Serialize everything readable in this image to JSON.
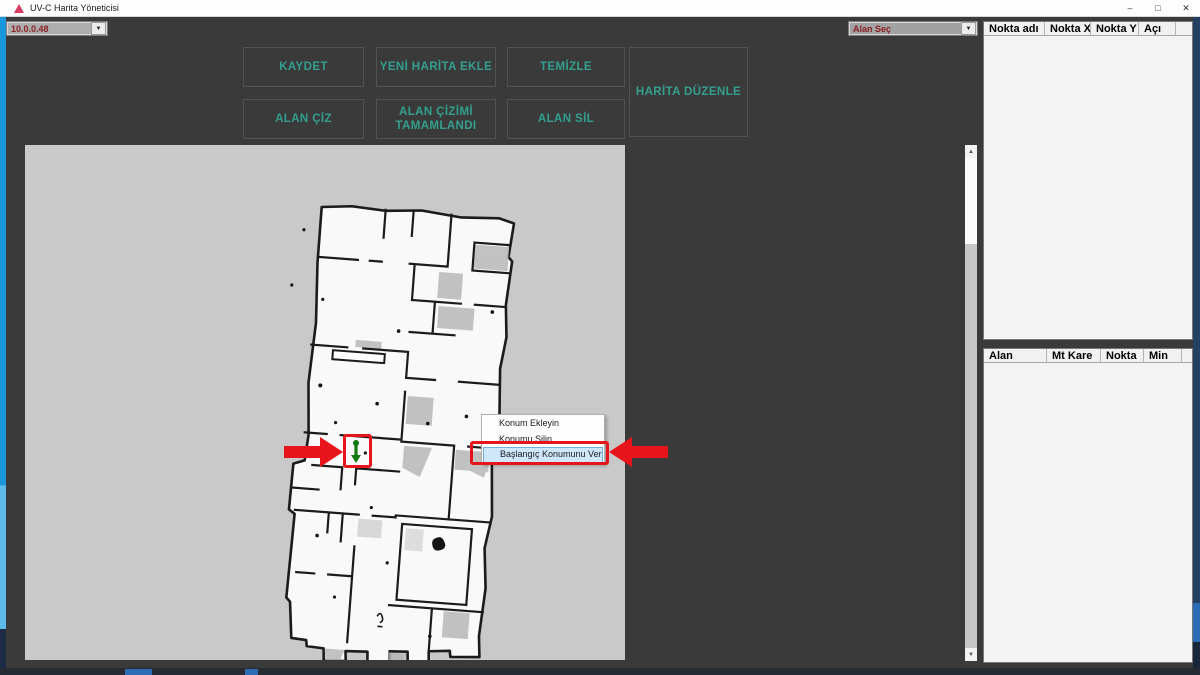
{
  "window": {
    "title": "UV-C Harita Yöneticisi",
    "minimize": "–",
    "maximize": "□",
    "close": "✕"
  },
  "header": {
    "ip_combo_value": "10.0.0.48",
    "area_combo_value": "Alan Seç",
    "dropdown_arrow": "▼"
  },
  "toolbar": {
    "buttons": [
      "KAYDET",
      "YENİ HARİTA EKLE",
      "TEMİZLE",
      "HARİTA DÜZENLE",
      "ALAN ÇİZ",
      "ALAN ÇİZİMİ TAMAMLANDI",
      "ALAN SİL"
    ]
  },
  "context_menu": {
    "items": [
      "Konum Ekleyin",
      "Konumu Silin",
      "Başlangıç Konumunu Ver"
    ],
    "highlighted_index": 2
  },
  "points_panel": {
    "columns": [
      "Nokta adı",
      "Nokta X",
      "Nokta Y",
      "Açı"
    ],
    "rows": []
  },
  "areas_panel": {
    "columns": [
      "Alan",
      "Mt Kare",
      "Nokta",
      "Min"
    ],
    "rows": []
  },
  "scrollbar": {
    "up": "▲",
    "down": "▼"
  },
  "colors": {
    "accent_teal": "#33a08f",
    "alert_red": "#e8141c",
    "menu_highlight": "#cfe7fb",
    "marker_green": "#117a11",
    "map_background": "#c9c9c9"
  }
}
